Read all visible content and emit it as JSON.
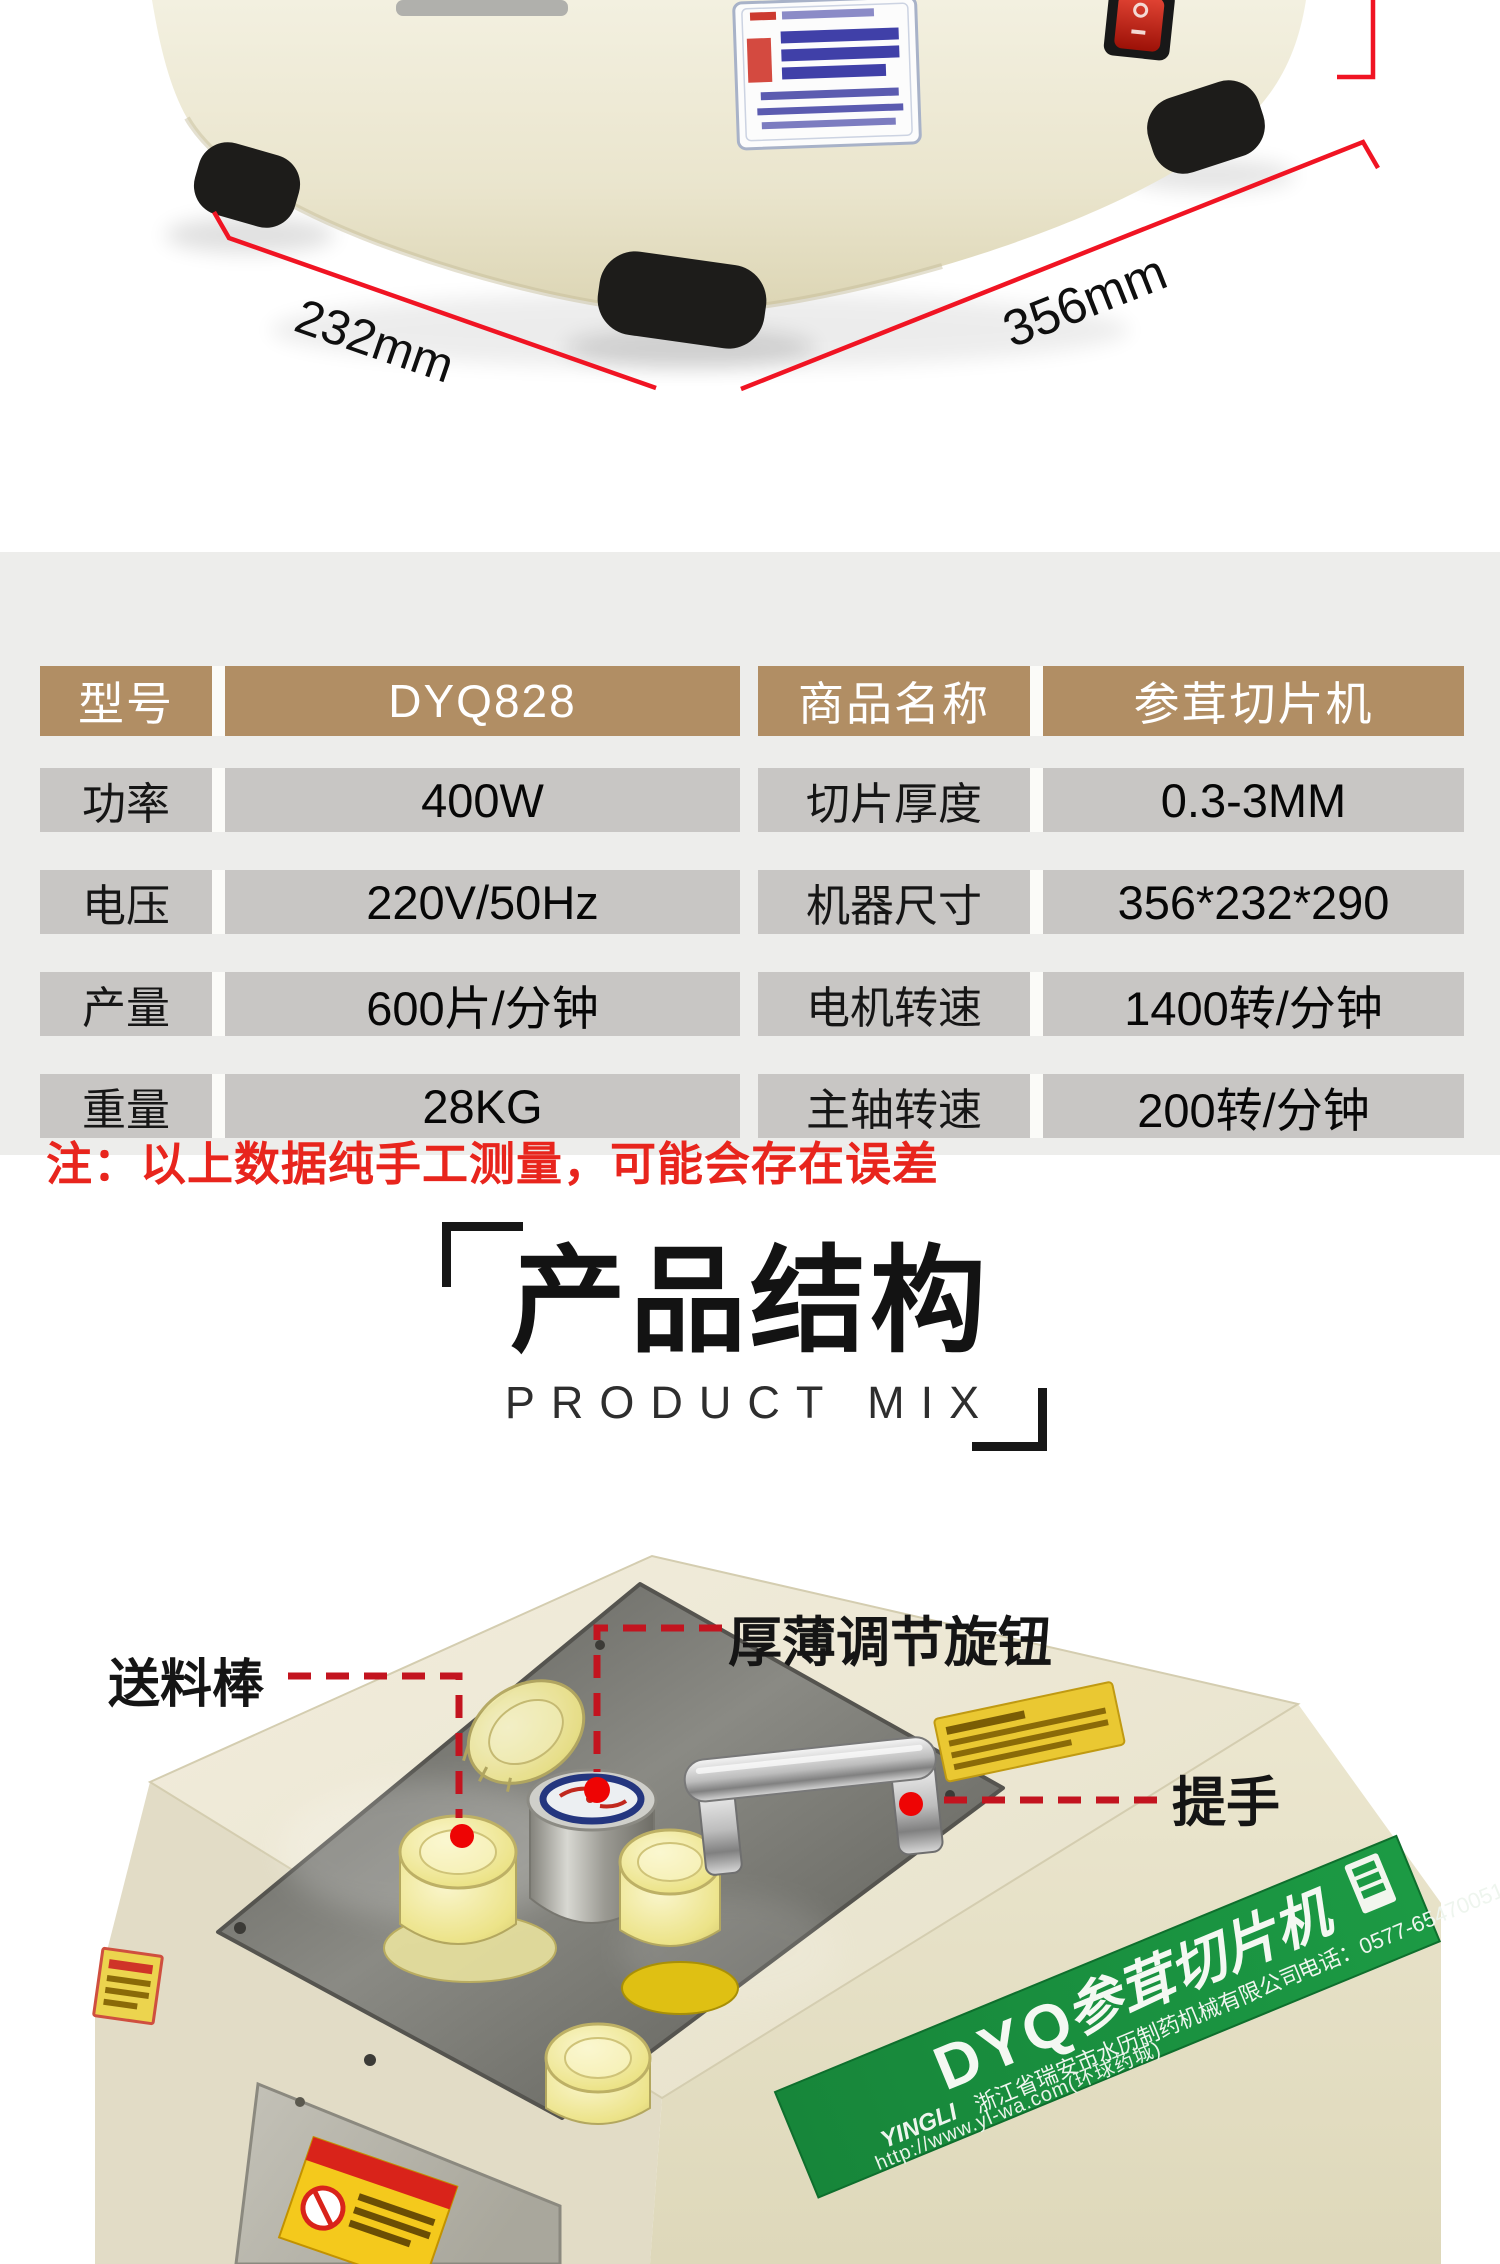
{
  "photo_top": {
    "width_label": "232mm",
    "depth_label": "356mm"
  },
  "spec": {
    "note": "注：以上数据纯手工测量，可能会存在误差",
    "left": [
      {
        "label": "型号",
        "value": "DYQ828"
      },
      {
        "label": "功率",
        "value": "400W"
      },
      {
        "label": "电压",
        "value": "220V/50Hz"
      },
      {
        "label": "产量",
        "value": "600片/分钟"
      },
      {
        "label": "重量",
        "value": "28KG"
      }
    ],
    "right": [
      {
        "label": "商品名称",
        "value": "参茸切片机"
      },
      {
        "label": "切片厚度",
        "value": "0.3-3MM"
      },
      {
        "label": "机器尺寸",
        "value": "356*232*290"
      },
      {
        "label": "电机转速",
        "value": "1400转/分钟"
      },
      {
        "label": "主轴转速",
        "value": "200转/分钟"
      }
    ]
  },
  "section": {
    "title": "产品结构",
    "subtitle": "PRODUCT MIX"
  },
  "callouts": {
    "feed_rod": "送料棒",
    "thickness_knob": "厚薄调节旋钮",
    "handle": "提手"
  },
  "banner": {
    "model": "DYQ",
    "product": "参茸切片机",
    "brand": "YINGLI",
    "company": "浙江省瑞安市水历制药机械有限公司",
    "phone": "电话：0577-65470051",
    "url": "http://www.yl-wa.com(环球药城)"
  },
  "colors": {
    "accent_red": "#e8251d",
    "dim_line_red": "#f01423",
    "table_header_brown": "#b18e64",
    "table_row_gray": "#c8c6c4",
    "panel_gray": "#ededeb",
    "banner_green": "#15873a",
    "machine_cream": "#efeada"
  }
}
